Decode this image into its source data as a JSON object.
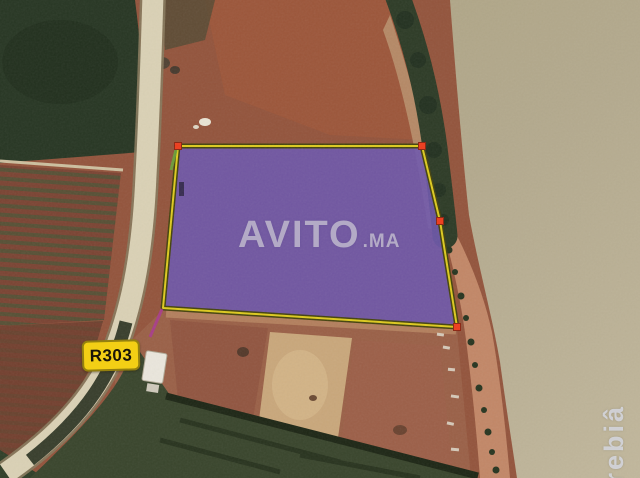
{
  "image": {
    "watermark": {
      "brand": "AVITO",
      "tld": ".MA"
    },
    "road_shield": {
      "label": "R303"
    },
    "river_watermark": {
      "text": "rrebiâ"
    },
    "parcel": {
      "fill_color": "#6e58ac",
      "border_color": "#ddca1f",
      "marker_color": "#ee3c1c",
      "marked_corners": 4,
      "sides": 5
    },
    "colors": {
      "river_tan": "#b3a98d",
      "field_red": "#8d4b37",
      "forest_green": "#273623",
      "road_tan": "#dad1b5",
      "scrub_green": "#39452c",
      "shield_yellow": "#f3cf15"
    }
  }
}
